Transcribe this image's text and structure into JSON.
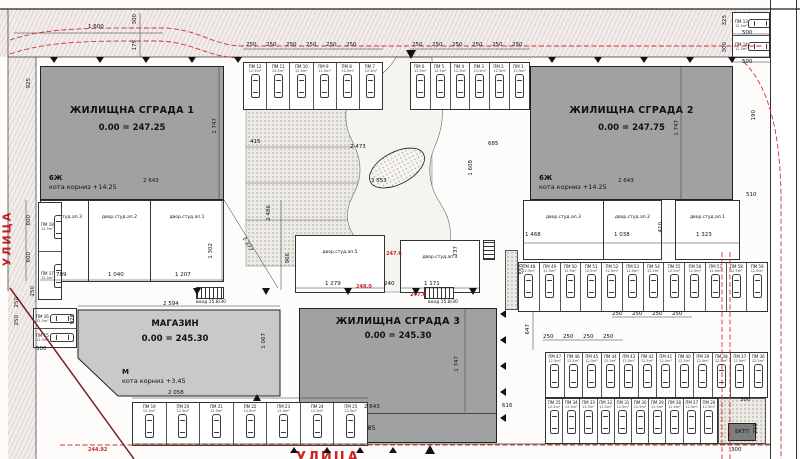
{
  "plan": {
    "street_left": "УЛИЦА",
    "street_bottom": "УЛИЦА",
    "transformer_label": "БКТП",
    "stairs_label": "вход 15.8/30",
    "colors": {
      "building": "#a1a1a1",
      "shop": "#c9c9c9",
      "red_line": "#cc2222",
      "boundary": "#7a2020"
    }
  },
  "buildings": {
    "b1": {
      "name": "ЖИЛИЩНА СГРАДА 1",
      "level": "0.00 = 247.25",
      "floors": "6Ж",
      "cornice": "кота корниз  +14.25"
    },
    "b2": {
      "name": "ЖИЛИЩНА СГРАДА 2",
      "level": "0.00 = 247.75",
      "floors": "6Ж",
      "cornice": "кота корниз  +14.25"
    },
    "b3": {
      "name": "ЖИЛИЩНА СГРАДА 3",
      "level": "0.00 = 245.30",
      "floors": "5Ж +М",
      "cornice": "кота корниз  +14.85"
    },
    "shop": {
      "name": "МАГАЗИН",
      "level": "0.00 = 245.30",
      "floors": "М",
      "cornice": "кота корниз  +3.45"
    }
  },
  "rooms": {
    "left": [
      "двор.студ.ап.3",
      "двор.студ.ап.2",
      "двор.студ.ап.1"
    ],
    "mid1": [
      "двор.студ.ап.5"
    ],
    "mid2": [
      "двор.студ.ап.4"
    ],
    "right1": [
      "двор.студ.ап.3",
      "двор.студ.ап.2"
    ],
    "right2": [
      "двор.студ.ап.1"
    ]
  },
  "parking": {
    "area_label": "12.5m²",
    "top_left_group": [
      "ПМ 12",
      "ПМ 11",
      "ПМ 10",
      "ПМ 9",
      "ПМ 8",
      "ПМ 7"
    ],
    "top_right_group": [
      "ПМ 6",
      "ПМ 5",
      "ПМ 4",
      "ПМ 3",
      "ПМ 2",
      "ПМ 1"
    ],
    "top_right_pair": [
      "ПМ 13",
      "ПМ 14"
    ],
    "left_edge": [
      "ПМ 18",
      "ПМ 17"
    ],
    "left_corner": [
      "ПМ 16",
      "ПМ 15"
    ],
    "bottom_left_row": [
      "ПМ 19",
      "ПМ 20",
      "ПМ 21",
      "ПМ 22",
      "ПМ 23",
      "ПМ 24",
      "ПМ 25"
    ],
    "row_a": [
      "ПМ 48",
      "ПМ 49",
      "ПМ 50",
      "ПМ 51",
      "ПМ 52",
      "ПМ 53",
      "ПМ 54",
      "ПМ 55",
      "ПМ 56",
      "ПМ 57",
      "ПМ 58",
      "ПМ 59"
    ],
    "row_b": [
      "ПМ 47",
      "ПМ 46",
      "ПМ 45",
      "ПМ 44",
      "ПМ 43",
      "ПМ 42",
      "ПМ 41",
      "ПМ 40",
      "ПМ 39",
      "ПМ 38",
      "ПМ 37",
      "ПМ 36"
    ],
    "row_c": [
      "ПМ 35",
      "ПМ 34",
      "ПМ 33",
      "ПМ 32",
      "ПМ 31",
      "ПМ 30",
      "ПМ 29",
      "ПМ 28",
      "ПМ 27",
      "ПМ 26"
    ]
  },
  "red_marks": [
    {
      "x": 386,
      "y": 251,
      "t": "247.6"
    },
    {
      "x": 356,
      "y": 284,
      "t": "248.0"
    },
    {
      "x": 410,
      "y": 292,
      "t": "247.6"
    },
    {
      "x": 88,
      "y": 447,
      "t": "244.92"
    }
  ],
  "dims": [
    [
      88,
      24,
      "1 600"
    ],
    [
      132,
      14,
      "300",
      -90
    ],
    [
      132,
      40,
      "175",
      -90
    ],
    [
      246,
      42,
      "250"
    ],
    [
      266,
      42,
      "250"
    ],
    [
      286,
      42,
      "250"
    ],
    [
      306,
      42,
      "250"
    ],
    [
      326,
      42,
      "250"
    ],
    [
      346,
      42,
      "250"
    ],
    [
      412,
      42,
      "250"
    ],
    [
      432,
      42,
      "250"
    ],
    [
      452,
      42,
      "250"
    ],
    [
      472,
      42,
      "250"
    ],
    [
      492,
      42,
      "250"
    ],
    [
      512,
      42,
      "250"
    ],
    [
      722,
      15,
      "325",
      -90
    ],
    [
      722,
      42,
      "300",
      -90
    ],
    [
      742,
      30,
      "500"
    ],
    [
      742,
      59,
      "500"
    ],
    [
      751,
      110,
      "190",
      -90
    ],
    [
      746,
      192,
      "510"
    ],
    [
      26,
      78,
      "925",
      -90
    ],
    [
      143,
      178,
      "2 643"
    ],
    [
      212,
      118,
      "1 747",
      -90
    ],
    [
      250,
      139,
      "415"
    ],
    [
      618,
      178,
      "2 643"
    ],
    [
      674,
      120,
      "1 747",
      -90
    ],
    [
      364,
      404,
      "2 643"
    ],
    [
      454,
      356,
      "1 747",
      -90
    ],
    [
      502,
      403,
      "616"
    ],
    [
      163,
      301,
      "2 594"
    ],
    [
      168,
      390,
      "2 058"
    ],
    [
      261,
      333,
      "1 067",
      -90
    ],
    [
      70,
      314,
      "978",
      -90
    ],
    [
      36,
      346,
      "500"
    ],
    [
      56,
      272,
      "789"
    ],
    [
      108,
      272,
      "1 040"
    ],
    [
      175,
      272,
      "1 207"
    ],
    [
      26,
      215,
      "600",
      -90
    ],
    [
      26,
      252,
      "600",
      -90
    ],
    [
      208,
      243,
      "1 302",
      -90
    ],
    [
      266,
      205,
      "2 486",
      -90
    ],
    [
      246,
      236,
      "1 377",
      62
    ],
    [
      285,
      253,
      "966",
      -90
    ],
    [
      325,
      281,
      "1 279"
    ],
    [
      384,
      281,
      "240"
    ],
    [
      424,
      281,
      "1 171"
    ],
    [
      453,
      246,
      "737",
      -90
    ],
    [
      525,
      232,
      "1 468"
    ],
    [
      614,
      232,
      "1 038"
    ],
    [
      696,
      232,
      "1 323"
    ],
    [
      658,
      222,
      "410",
      -90
    ],
    [
      350,
      144,
      "2 473"
    ],
    [
      371,
      178,
      "3 553"
    ],
    [
      488,
      141,
      "685"
    ],
    [
      468,
      160,
      "1 608",
      -90
    ],
    [
      519,
      264,
      "550",
      -90
    ],
    [
      525,
      324,
      "647",
      -90
    ],
    [
      612,
      311,
      "250"
    ],
    [
      632,
      311,
      "250"
    ],
    [
      652,
      311,
      "250"
    ],
    [
      672,
      311,
      "250"
    ],
    [
      543,
      334,
      "250"
    ],
    [
      563,
      334,
      "250"
    ],
    [
      583,
      334,
      "250"
    ],
    [
      603,
      334,
      "250"
    ],
    [
      731,
      447,
      "300"
    ],
    [
      753,
      423,
      "210",
      -90
    ],
    [
      740,
      397,
      "300"
    ],
    [
      30,
      286,
      "250",
      -90
    ],
    [
      14,
      297,
      "250",
      -90
    ],
    [
      14,
      315,
      "250",
      -90
    ]
  ],
  "markers": [
    [
      50,
      57,
      "d",
      6
    ],
    [
      96,
      57,
      "d",
      6
    ],
    [
      142,
      57,
      "d",
      6
    ],
    [
      188,
      57,
      "d",
      6
    ],
    [
      234,
      57,
      "d",
      6
    ],
    [
      548,
      57,
      "d",
      6
    ],
    [
      594,
      57,
      "d",
      6
    ],
    [
      640,
      57,
      "d",
      6
    ],
    [
      686,
      57,
      "d",
      6
    ],
    [
      728,
      57,
      "d",
      6
    ],
    [
      406,
      50,
      "d",
      9
    ],
    [
      193,
      288,
      "d",
      7
    ],
    [
      262,
      288,
      "d",
      7
    ],
    [
      344,
      288,
      "d",
      7
    ],
    [
      412,
      288,
      "d",
      7
    ],
    [
      469,
      288,
      "d",
      7
    ],
    [
      500,
      310,
      "l",
      6
    ],
    [
      500,
      336,
      "l",
      6
    ],
    [
      500,
      362,
      "l",
      6
    ],
    [
      500,
      388,
      "l",
      6
    ],
    [
      500,
      414,
      "l",
      6
    ],
    [
      290,
      447,
      "u",
      6
    ],
    [
      323,
      447,
      "u",
      6
    ],
    [
      356,
      447,
      "u",
      6
    ],
    [
      389,
      447,
      "u",
      6
    ],
    [
      425,
      445,
      "u",
      9
    ],
    [
      253,
      394,
      "u",
      7
    ]
  ]
}
